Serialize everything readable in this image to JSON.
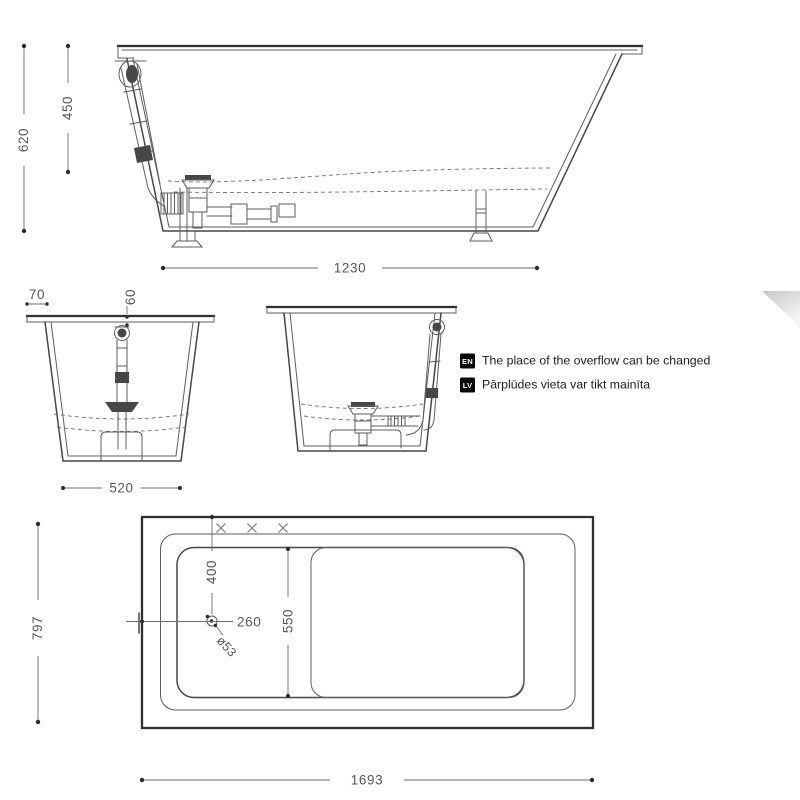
{
  "dims": {
    "side_height": "620",
    "side_inner_height": "450",
    "side_length": "1230",
    "end_rim_edge": "70",
    "end_overflow_offset": "60",
    "end_width": "520",
    "plan_width": "797",
    "plan_overflow_x": "400",
    "plan_drain_x": "260",
    "plan_basin_width": "550",
    "plan_drain_diameter": "ø53",
    "plan_length": "1693"
  },
  "notes": [
    {
      "badge": "EN",
      "text": "The place of the overflow can be changed"
    },
    {
      "badge": "LV",
      "text": "Pārplūdes vieta var tikt mainīta"
    }
  ],
  "colors": {
    "line": "#474747",
    "dim_text": "#585858",
    "note_badge": "#060606",
    "background": "#ffffff"
  }
}
